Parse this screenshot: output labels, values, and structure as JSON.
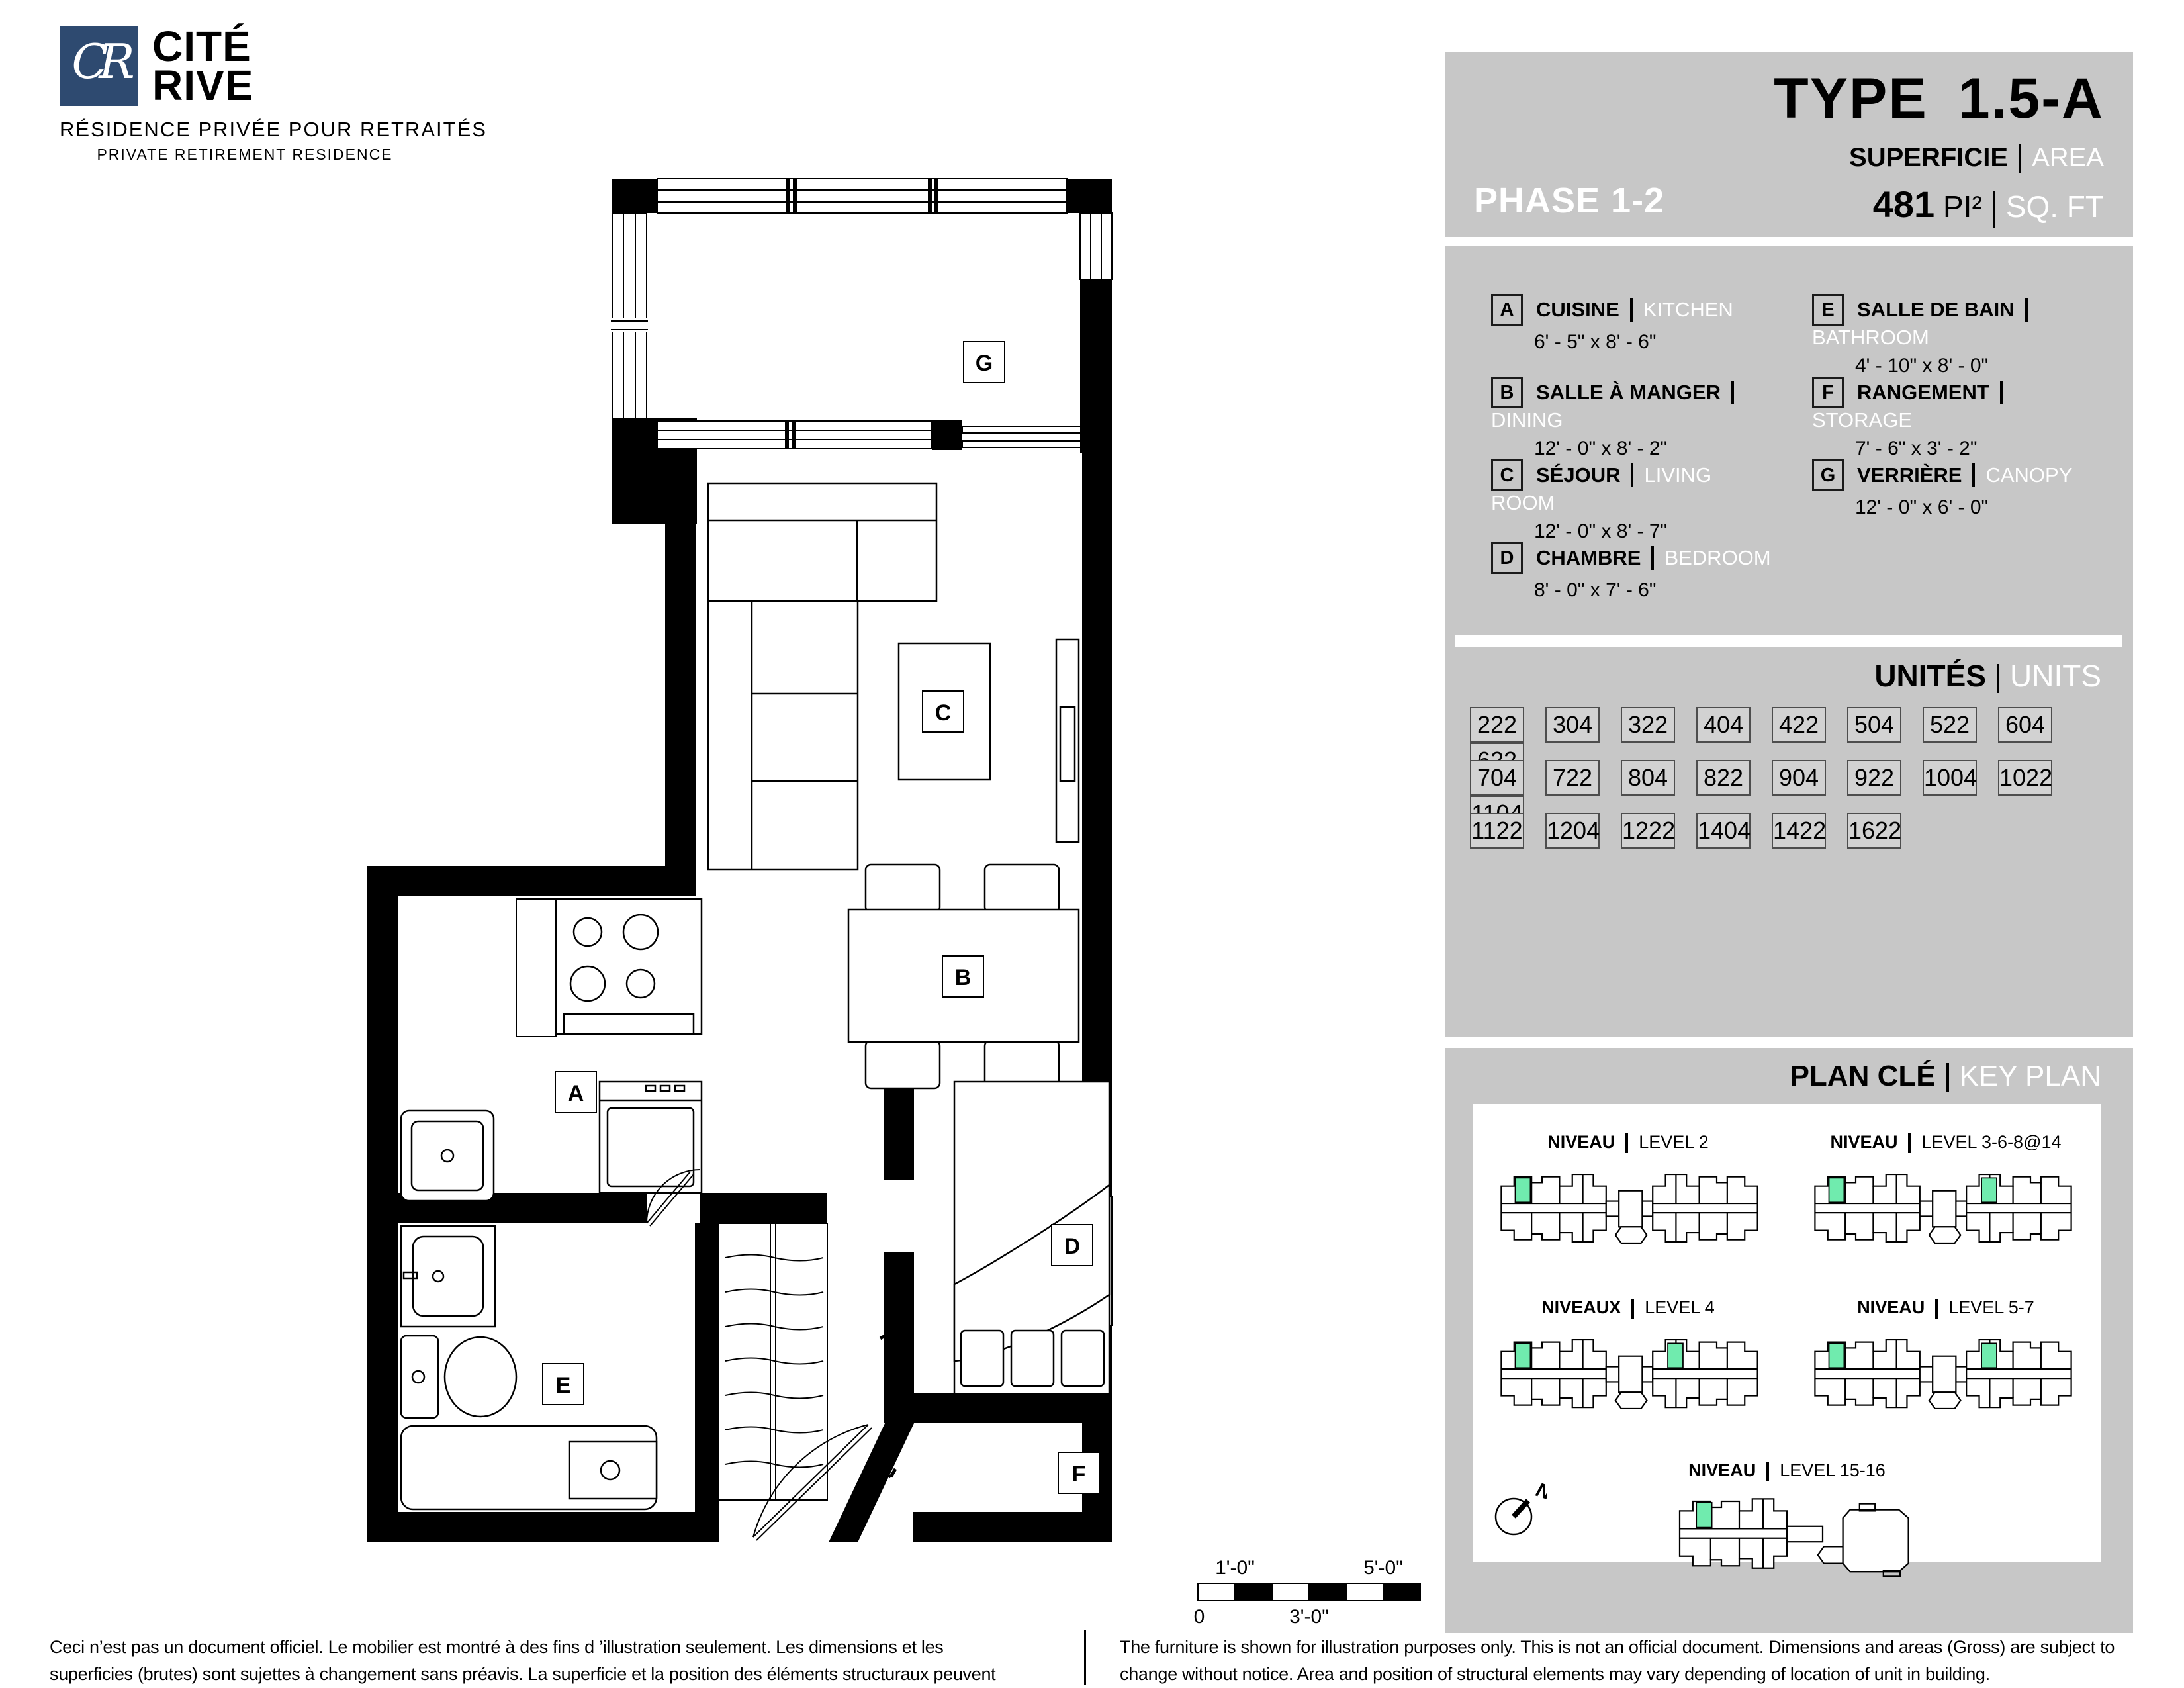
{
  "logo": {
    "initials": "CR",
    "name_line1": "CITÉ",
    "name_line2": "RIVE",
    "subtitle_fr": "RÉSIDENCE PRIVÉE POUR RETRAITÉS",
    "subtitle_en": "PRIVATE RETIREMENT RESIDENCE",
    "brand_color": "#2e4a70"
  },
  "header": {
    "phase": "PHASE 1-2",
    "type_prefix": "TYPE",
    "type_value": "1.5-A",
    "superficie": "SUPERFICIE",
    "area": "AREA",
    "area_value": "481",
    "unit_fr": "PI²",
    "unit_en": "SQ. FT"
  },
  "legend": {
    "items": [
      {
        "key": "A",
        "fr": "CUISINE",
        "en": "KITCHEN",
        "dim": "6' - 5\" x 8' - 6\""
      },
      {
        "key": "B",
        "fr": "SALLE À MANGER",
        "en": "DINING",
        "dim": "12' - 0\" x 8' - 2\""
      },
      {
        "key": "C",
        "fr": "SÉJOUR",
        "en": "LIVING ROOM",
        "dim": "12' - 0\" x 8' - 7\""
      },
      {
        "key": "D",
        "fr": "CHAMBRE",
        "en": "BEDROOM",
        "dim": "8' - 0\" x 7' - 6\""
      },
      {
        "key": "E",
        "fr": "SALLE DE BAIN",
        "en": "BATHROOM",
        "dim": "4' - 10\" x 8' - 0\""
      },
      {
        "key": "F",
        "fr": "RANGEMENT",
        "en": "STORAGE",
        "dim": "7' - 6\" x 3' - 2\""
      },
      {
        "key": "G",
        "fr": "VERRIÈRE",
        "en": "CANOPY",
        "dim": "12' - 0\" x 6' - 0\""
      }
    ]
  },
  "units": {
    "title_fr": "UNITÉS",
    "title_en": "UNITS",
    "rows": [
      [
        "222",
        "304",
        "322",
        "404",
        "422",
        "504",
        "522",
        "604",
        "622"
      ],
      [
        "704",
        "722",
        "804",
        "822",
        "904",
        "922",
        "1004",
        "1022",
        "1104"
      ],
      [
        "1122",
        "1204",
        "1222",
        "1404",
        "1422",
        "1622"
      ]
    ]
  },
  "key_plan": {
    "title_fr": "PLAN CLÉ",
    "title_en": "KEY PLAN",
    "levels": [
      {
        "fr": "NIVEAU",
        "en": "LEVEL 2"
      },
      {
        "fr": "NIVEAU",
        "en": "LEVEL 3-6-8@14"
      },
      {
        "fr": "NIVEAUX",
        "en": "LEVEL 4"
      },
      {
        "fr": "NIVEAU",
        "en": "LEVEL 5-7"
      },
      {
        "fr": "NIVEAU",
        "en": "LEVEL 15-16"
      }
    ],
    "compass_label": "N",
    "highlight_color": "#70ebae"
  },
  "floor_plan": {
    "labels": {
      "a": "A",
      "b": "B",
      "c": "C",
      "d": "D",
      "e": "E",
      "f": "F",
      "g": "G"
    }
  },
  "scale_bar": {
    "top_left": "1'-0\"",
    "top_right": "5'-0\"",
    "bottom_left": "0",
    "bottom_mid": "3'-0\""
  },
  "disclaimers": {
    "fr": "Ceci n’est pas un document officiel.  Le mobilier est montré à des fins d ’illustration seulement.  Les dimensions et les superficies (brutes) sont sujettes à changement sans préavis. La superficie et la position des éléments structuraux peuvent varier en fonction de l'emplacement de l'unité dans le bâtiment.",
    "en": "The furniture is shown for illustration purposes only.  This is not an official document.  Dimensions and areas (Gross) are subject to change without notice. Area and position of structural elements may vary depending of location of unit in building."
  }
}
